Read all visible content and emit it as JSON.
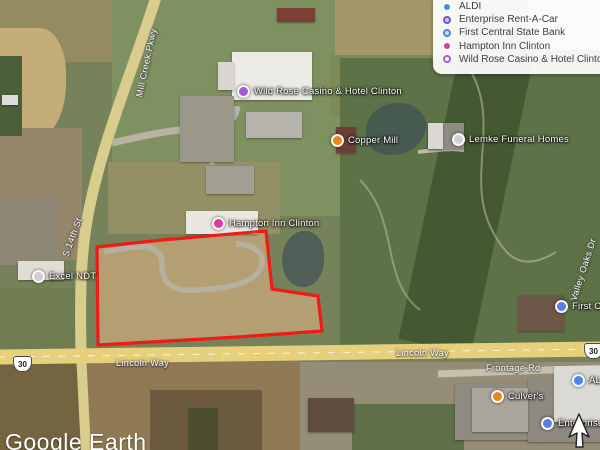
{
  "watermark": "Google Earth",
  "legend": {
    "items": [
      {
        "label": "ALDI",
        "marker_color": "#4a86e8",
        "marker_style": "filled"
      },
      {
        "label": "Enterprise Rent-A-Car",
        "marker_color": "#6a5acd",
        "marker_style": "ring"
      },
      {
        "label": "First Central State Bank",
        "marker_color": "#4a86e8",
        "marker_style": "ring"
      },
      {
        "label": "Hampton Inn Clinton",
        "marker_color": "#e03aa0",
        "marker_style": "filled"
      },
      {
        "label": "Wild Rose Casino & Hotel Clinton",
        "marker_color": "#a85ad6",
        "marker_style": "ring"
      }
    ]
  },
  "map": {
    "pois": [
      {
        "label": "Wild Rose Casino & Hotel Clinton",
        "marker_color": "#a85ad6"
      },
      {
        "label": "Copper Mill",
        "marker_color": "#e8861c"
      },
      {
        "label": "Hampton Inn Clinton",
        "marker_color": "#e03aa0"
      },
      {
        "label": "Lemke Funeral Homes",
        "marker_color": "#cfcfd4"
      },
      {
        "label": "Excel NDT",
        "marker_color": "#cfcfd4"
      },
      {
        "label": "Culver's",
        "marker_color": "#e8861c"
      },
      {
        "label": "ALDI",
        "marker_color": "#4a86e8"
      },
      {
        "label": "Enterprise Rent-A-Car",
        "marker_color": "#5b7de0"
      },
      {
        "label": "First Central State Bank",
        "marker_color": "#5b7de0"
      }
    ],
    "roads": [
      {
        "label": "Lincoln Way"
      },
      {
        "label": "Lincoln Way"
      },
      {
        "label": "Frontage Rd"
      },
      {
        "label": "Mill Creek Pkwy"
      },
      {
        "label": "S 14th St"
      },
      {
        "label": "Valley Oaks Dr"
      }
    ],
    "shields": [
      {
        "label": "30"
      },
      {
        "label": "30"
      }
    ],
    "colors": {
      "parcel_outline": "#ed1c16",
      "highway_fill": "#e7d07c",
      "water": "#4f5e56"
    }
  }
}
